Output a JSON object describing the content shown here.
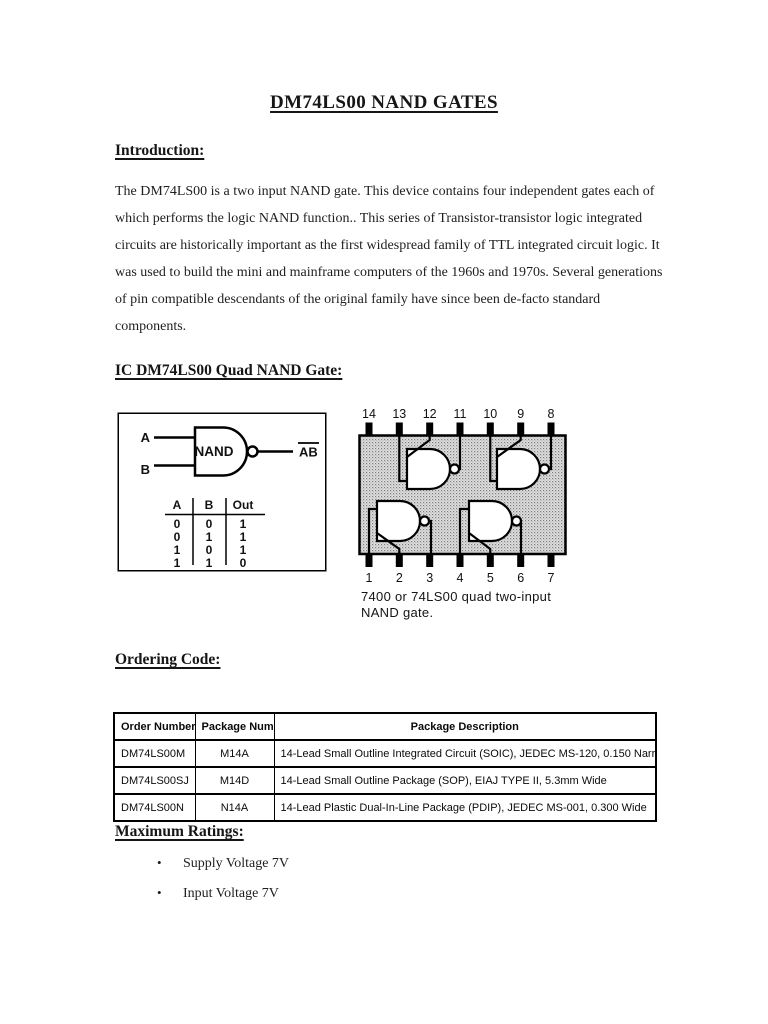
{
  "page": {
    "title": "DM74LS00 NAND GATES"
  },
  "introduction": {
    "heading": "Introduction:",
    "body": "The DM74LS00 is a two input NAND gate. This device contains four independent gates each of which performs the logic NAND function.. This series of Transistor-transistor logic integrated circuits are historically important as the first widespread family of TTL integrated circuit logic.  It was used to build the mini and mainframe computers of the 1960s and 1970s. Several generations of pin compatible descendants of the original family have since been de-facto standard components."
  },
  "ic_section": {
    "heading": "IC DM74LS00 Quad NAND Gate:",
    "gate_figure": {
      "input_a": "A",
      "input_b": "B",
      "gate_label": "NAND",
      "output_label": "AB",
      "truth_table": {
        "headers": [
          "A",
          "B",
          "Out"
        ],
        "rows": [
          [
            "0",
            "0",
            "1"
          ],
          [
            "0",
            "1",
            "1"
          ],
          [
            "1",
            "0",
            "1"
          ],
          [
            "1",
            "1",
            "0"
          ]
        ]
      }
    },
    "ic_figure": {
      "top_pins": [
        "14",
        "13",
        "12",
        "11",
        "10",
        "9",
        "8"
      ],
      "bottom_pins": [
        "1",
        "2",
        "3",
        "4",
        "5",
        "6",
        "7"
      ],
      "caption_line1": "7400 or 74LS00 quad two-input",
      "caption_line2": "NAND gate."
    }
  },
  "ordering": {
    "heading": "Ordering Code:",
    "table": {
      "headers": [
        "Order Number",
        "Package Number",
        "Package Description"
      ],
      "rows": [
        [
          "DM74LS00M",
          "M14A",
          "14-Lead Small Outline Integrated Circuit (SOIC), JEDEC MS-120, 0.150 Narrow"
        ],
        [
          "DM74LS00SJ",
          "M14D",
          "14-Lead Small Outline Package (SOP), EIAJ TYPE II, 5.3mm Wide"
        ],
        [
          "DM74LS00N",
          "N14A",
          "14-Lead Plastic Dual-In-Line Package (PDIP), JEDEC MS-001, 0.300 Wide"
        ]
      ]
    }
  },
  "ratings": {
    "heading": "Maximum Ratings:",
    "items": [
      "Supply Voltage 7V",
      "Input Voltage 7V"
    ]
  }
}
